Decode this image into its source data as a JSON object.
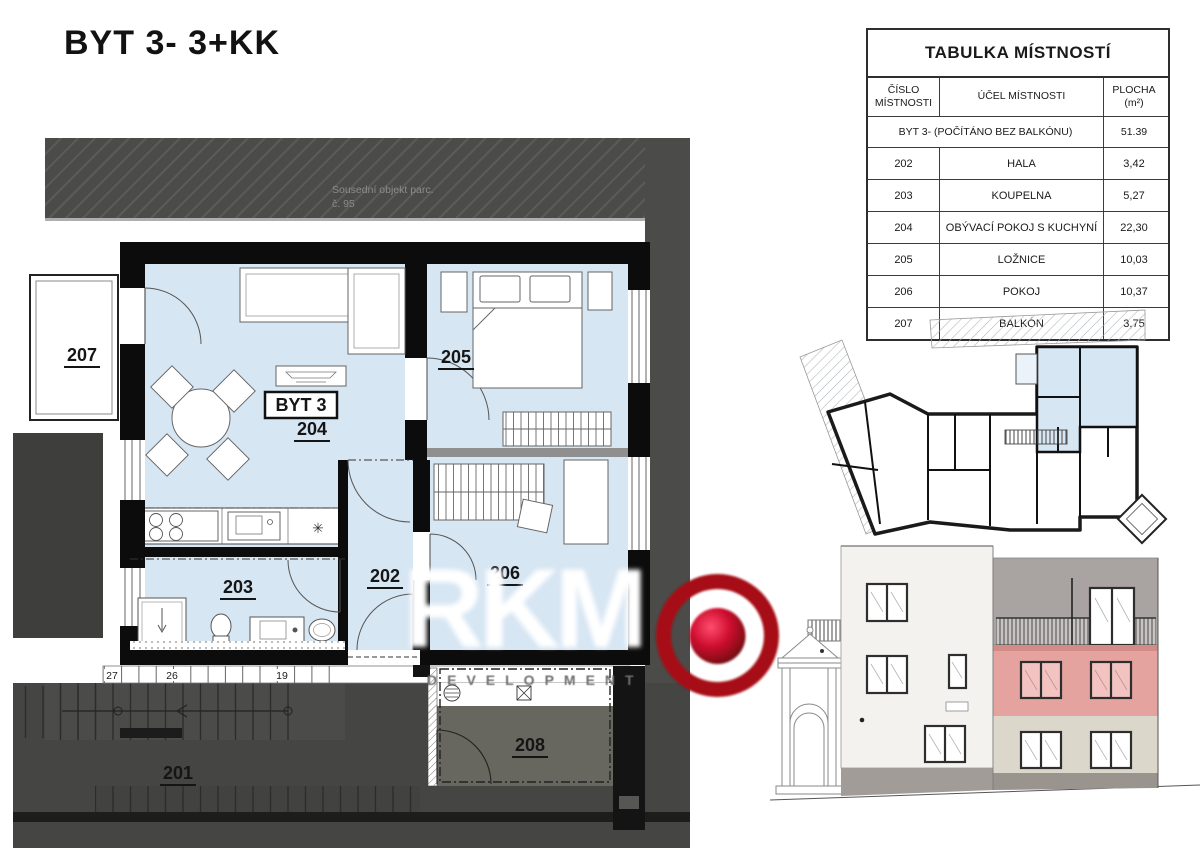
{
  "page_title": "BYT 3- 3+KK",
  "table": {
    "title": "TABULKA MÍSTNOSTÍ",
    "headers": {
      "col1_line1": "ČÍSLO",
      "col1_line2": "MÍSTNOSTI",
      "col2": "ÚČEL MÍSTNOSTI",
      "col3_line1": "PLOCHA",
      "col3_line2": "(m²)"
    },
    "summary_row": {
      "label": "BYT 3- (POČÍTÁNO BEZ BALKÓNU)",
      "area": "51.39"
    },
    "rows": [
      {
        "number": "202",
        "purpose": "HALA",
        "area": "3,42"
      },
      {
        "number": "203",
        "purpose": "KOUPELNA",
        "area": "5,27"
      },
      {
        "number": "204",
        "purpose": "OBÝVACÍ POKOJ S KUCHYNÍ",
        "area": "22,30"
      },
      {
        "number": "205",
        "purpose": "LOŽNICE",
        "area": "10,03"
      },
      {
        "number": "206",
        "purpose": "POKOJ",
        "area": "10,37"
      },
      {
        "number": "207",
        "purpose": "BALKÓN",
        "area": "3,75"
      }
    ]
  },
  "plan": {
    "apartment_label": "BYT 3",
    "neighbor_note_line1": "Sousední objekt parc.",
    "neighbor_note_line2": "č. 95",
    "rooms": {
      "r201": "201",
      "r202": "202",
      "r203": "203",
      "r204": "204",
      "r205": "205",
      "r206": "206",
      "r207": "207",
      "r208": "208"
    },
    "dims": [
      "27",
      "26",
      "19"
    ],
    "symbols": {
      "boiler": "✳"
    }
  },
  "logo": {
    "name": "RKM",
    "subtitle": "DEVELOPMENT"
  },
  "colors": {
    "room_blue": "#d7e6f3",
    "band_gray": "#4b4b49",
    "room_gray": "#67665f",
    "highlight_pink": "#e5a39f",
    "facade_beige": "#dcd7cb",
    "facade_gray": "#a9a3a1",
    "facade_white": "#f4f2ee",
    "logo_red": "#a60f16"
  }
}
